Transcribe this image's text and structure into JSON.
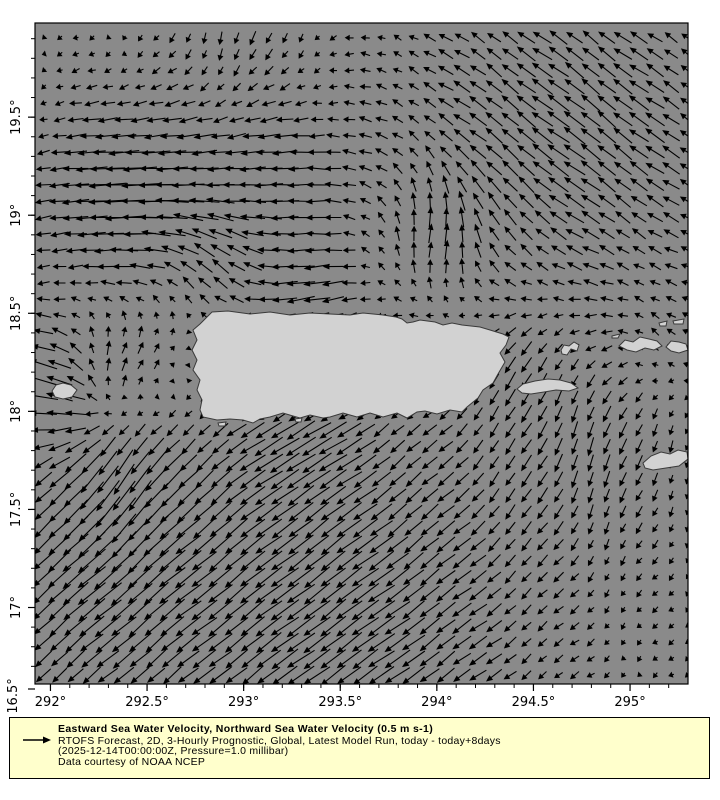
{
  "legend": {
    "title": "Eastward Sea Water Velocity, Northward Sea Water Velocity (0.5 m s-1)",
    "line2": "RTOFS Forecast, 2D, 3-Hourly Prognostic, Global, Latest Model Run, today - today+8days",
    "line3": "(2025-12-14T00:00:00Z, Pressure=1.0 millibar)",
    "line4": "Data courtesy of NOAA NCEP",
    "bg_color": "#ffffcc",
    "reference_arrow_icon": "right-arrow"
  },
  "axes": {
    "x_ticks": [
      {
        "value": 292.0,
        "label": "292°"
      },
      {
        "value": 292.5,
        "label": "292.5°"
      },
      {
        "value": 293.0,
        "label": "293°"
      },
      {
        "value": 293.5,
        "label": "293.5°"
      },
      {
        "value": 294.0,
        "label": "294°"
      },
      {
        "value": 294.5,
        "label": "294.5°"
      },
      {
        "value": 295.0,
        "label": "295°"
      }
    ],
    "y_ticks": [
      {
        "value": 19.5,
        "label": "19.5°"
      },
      {
        "value": 19.0,
        "label": "19°"
      },
      {
        "value": 18.5,
        "label": "18.5°"
      },
      {
        "value": 18.0,
        "label": "18°"
      },
      {
        "value": 17.5,
        "label": "17.5°"
      },
      {
        "value": 17.0,
        "label": "17°"
      }
    ],
    "y_corner_label": "16.5°",
    "minor_step_deg": 0.1
  },
  "map": {
    "sea_color": "#8a8a8a",
    "land_color": "#d2d2d2",
    "land_outline_color": "#3a3a3a",
    "border_color": "#000000",
    "islands": [
      {
        "name": "puerto-rico",
        "points": [
          [
            207,
            317
          ],
          [
            212,
            312
          ],
          [
            228,
            311
          ],
          [
            250,
            314
          ],
          [
            270,
            312
          ],
          [
            290,
            315
          ],
          [
            310,
            313
          ],
          [
            330,
            314
          ],
          [
            350,
            315
          ],
          [
            363,
            313
          ],
          [
            383,
            315
          ],
          [
            396,
            317
          ],
          [
            402,
            319
          ],
          [
            407,
            323
          ],
          [
            413,
            322
          ],
          [
            420,
            320
          ],
          [
            435,
            322
          ],
          [
            443,
            325
          ],
          [
            452,
            323
          ],
          [
            462,
            325
          ],
          [
            480,
            327
          ],
          [
            490,
            330
          ],
          [
            503,
            334
          ],
          [
            509,
            337
          ],
          [
            506,
            345
          ],
          [
            500,
            353
          ],
          [
            505,
            362
          ],
          [
            498,
            374
          ],
          [
            493,
            383
          ],
          [
            483,
            390
          ],
          [
            478,
            398
          ],
          [
            467,
            407
          ],
          [
            462,
            412
          ],
          [
            450,
            410
          ],
          [
            437,
            414
          ],
          [
            425,
            411
          ],
          [
            417,
            412
          ],
          [
            407,
            418
          ],
          [
            397,
            413
          ],
          [
            383,
            417
          ],
          [
            370,
            413
          ],
          [
            357,
            417
          ],
          [
            343,
            413
          ],
          [
            330,
            417
          ],
          [
            323,
            418
          ],
          [
            310,
            415
          ],
          [
            300,
            418
          ],
          [
            293,
            416
          ],
          [
            283,
            413
          ],
          [
            270,
            417
          ],
          [
            260,
            419
          ],
          [
            253,
            423
          ],
          [
            243,
            420
          ],
          [
            230,
            419
          ],
          [
            217,
            420
          ],
          [
            203,
            417
          ],
          [
            200,
            410
          ],
          [
            202,
            400
          ],
          [
            197,
            390
          ],
          [
            200,
            380
          ],
          [
            193,
            370
          ],
          [
            197,
            360
          ],
          [
            192,
            350
          ],
          [
            197,
            340
          ],
          [
            193,
            330
          ],
          [
            200,
            324
          ],
          [
            203,
            321
          ]
        ]
      },
      {
        "name": "mona-island",
        "points": [
          [
            52,
            391
          ],
          [
            56,
            385
          ],
          [
            63,
            383
          ],
          [
            71,
            385
          ],
          [
            77,
            390
          ],
          [
            72,
            397
          ],
          [
            63,
            399
          ],
          [
            55,
            397
          ]
        ]
      },
      {
        "name": "vieques",
        "points": [
          [
            517,
            389
          ],
          [
            523,
            384
          ],
          [
            535,
            381
          ],
          [
            548,
            379
          ],
          [
            560,
            380
          ],
          [
            571,
            383
          ],
          [
            578,
            388
          ],
          [
            569,
            391
          ],
          [
            556,
            390
          ],
          [
            544,
            392
          ],
          [
            531,
            394
          ],
          [
            522,
            393
          ]
        ]
      },
      {
        "name": "culebra",
        "points": [
          [
            561,
            350
          ],
          [
            564,
            345
          ],
          [
            569,
            346
          ],
          [
            574,
            342
          ],
          [
            579,
            345
          ],
          [
            577,
            351
          ],
          [
            571,
            349
          ],
          [
            567,
            355
          ],
          [
            562,
            354
          ]
        ]
      },
      {
        "name": "st-thomas",
        "points": [
          [
            619,
            346
          ],
          [
            625,
            340
          ],
          [
            633,
            342
          ],
          [
            640,
            337
          ],
          [
            649,
            339
          ],
          [
            657,
            341
          ],
          [
            662,
            346
          ],
          [
            654,
            350
          ],
          [
            645,
            348
          ],
          [
            636,
            352
          ],
          [
            627,
            350
          ]
        ]
      },
      {
        "name": "st-john",
        "points": [
          [
            666,
            347
          ],
          [
            671,
            341
          ],
          [
            679,
            342
          ],
          [
            686,
            344
          ],
          [
            688,
            350
          ],
          [
            679,
            353
          ],
          [
            671,
            351
          ]
        ]
      },
      {
        "name": "st-croix",
        "points": [
          [
            643,
            463
          ],
          [
            651,
            456
          ],
          [
            661,
            452
          ],
          [
            670,
            454
          ],
          [
            678,
            450
          ],
          [
            687,
            452
          ],
          [
            688,
            459
          ],
          [
            679,
            466
          ],
          [
            666,
            468
          ],
          [
            653,
            470
          ],
          [
            645,
            468
          ]
        ]
      },
      {
        "name": "cay-northeast-1",
        "points": [
          [
            612,
            336
          ],
          [
            620,
            334
          ],
          [
            618,
            338
          ],
          [
            612,
            338
          ]
        ]
      },
      {
        "name": "cay-northeast-2",
        "points": [
          [
            659,
            323
          ],
          [
            667,
            321
          ],
          [
            666,
            326
          ],
          [
            660,
            326
          ]
        ]
      },
      {
        "name": "cay-northeast-3",
        "points": [
          [
            673,
            321
          ],
          [
            684,
            319
          ],
          [
            683,
            324
          ],
          [
            674,
            324
          ]
        ]
      },
      {
        "name": "islet-south-1",
        "points": [
          [
            295,
            419
          ],
          [
            302,
            418
          ],
          [
            301,
            422
          ],
          [
            296,
            422
          ]
        ]
      },
      {
        "name": "islet-south-2",
        "points": [
          [
            218,
            423
          ],
          [
            226,
            422
          ],
          [
            225,
            426
          ],
          [
            219,
            426
          ]
        ]
      }
    ]
  },
  "chart_data": {
    "type": "quiver",
    "title": "Eastward Sea Water Velocity, Northward Sea Water Velocity (0.5 m s-1)",
    "u_component": "Eastward Sea Water Velocity",
    "v_component": "Northward Sea Water Velocity",
    "units": "m s-1",
    "reference_vector_ms": 0.5,
    "arrow_color": "#000000",
    "lon_range": [
      291.92,
      295.3
    ],
    "lat_range": [
      16.61,
      19.98
    ],
    "grid_step_deg": 0.0833,
    "px_per_ms": 46,
    "max_arrow_px": 44,
    "jitter_ms": 0.035,
    "base_flow": {
      "u": -0.05,
      "v": -0.05
    },
    "flow_features": [
      {
        "name": "northeast-quadrant-northwestward-flow",
        "lon": 294.7,
        "lat": 19.45,
        "u": -0.38,
        "v": 0.38,
        "r": 1.0
      },
      {
        "name": "north-westward-jet-west-lobe",
        "lon": 292.4,
        "lat": 19.1,
        "u": -0.75,
        "v": 0.02,
        "r": 0.45
      },
      {
        "name": "north-westward-jet-east-lobe",
        "lon": 293.15,
        "lat": 19.15,
        "u": -0.45,
        "v": 0.0,
        "r": 0.4
      },
      {
        "name": "top-edge-southward-band",
        "lon": 293.0,
        "lat": 20.05,
        "u": 0.0,
        "v": -0.25,
        "r": 0.45
      },
      {
        "name": "northeastward-northeast-of-pr",
        "lon": 294.0,
        "lat": 18.9,
        "u": 0.28,
        "v": 0.3,
        "r": 0.35
      },
      {
        "name": "westward-along-north-coast",
        "lon": 293.3,
        "lat": 18.6,
        "u": -0.35,
        "v": -0.02,
        "r": 0.28
      },
      {
        "name": "northward-northwest-of-pr",
        "lon": 292.85,
        "lat": 18.75,
        "u": 0.05,
        "v": 0.35,
        "r": 0.3
      },
      {
        "name": "mona-passage-northeastward",
        "lon": 292.4,
        "lat": 18.25,
        "u": 0.4,
        "v": 0.35,
        "r": 0.35
      },
      {
        "name": "west-edge-northwestward",
        "lon": 291.95,
        "lat": 18.15,
        "u": -0.55,
        "v": 0.2,
        "r": 0.35
      },
      {
        "name": "caribbean-broad-southwestward",
        "lon": 293.2,
        "lat": 17.35,
        "u": -0.3,
        "v": -0.25,
        "r": 1.1
      },
      {
        "name": "west-caribbean-southwestward",
        "lon": 292.15,
        "lat": 17.1,
        "u": -0.35,
        "v": -0.3,
        "r": 0.6
      },
      {
        "name": "southward-east-of-pr",
        "lon": 294.8,
        "lat": 17.9,
        "u": -0.02,
        "v": -0.3,
        "r": 0.6
      },
      {
        "name": "vieques-sound-southward",
        "lon": 294.35,
        "lat": 18.25,
        "u": 0.0,
        "v": -0.2,
        "r": 0.25
      },
      {
        "name": "bottom-edge-southwestward",
        "lon": 293.6,
        "lat": 16.7,
        "u": -0.3,
        "v": -0.18,
        "r": 0.9
      },
      {
        "name": "right-edge-northward-patch",
        "lon": 295.15,
        "lat": 18.3,
        "u": -0.02,
        "v": 0.22,
        "r": 0.25
      },
      {
        "name": "south-coast-westward",
        "lon": 293.3,
        "lat": 17.85,
        "u": -0.3,
        "v": -0.1,
        "r": 0.3
      },
      {
        "name": "mona-south-southward",
        "lon": 292.35,
        "lat": 17.65,
        "u": -0.12,
        "v": -0.35,
        "r": 0.3
      }
    ]
  }
}
